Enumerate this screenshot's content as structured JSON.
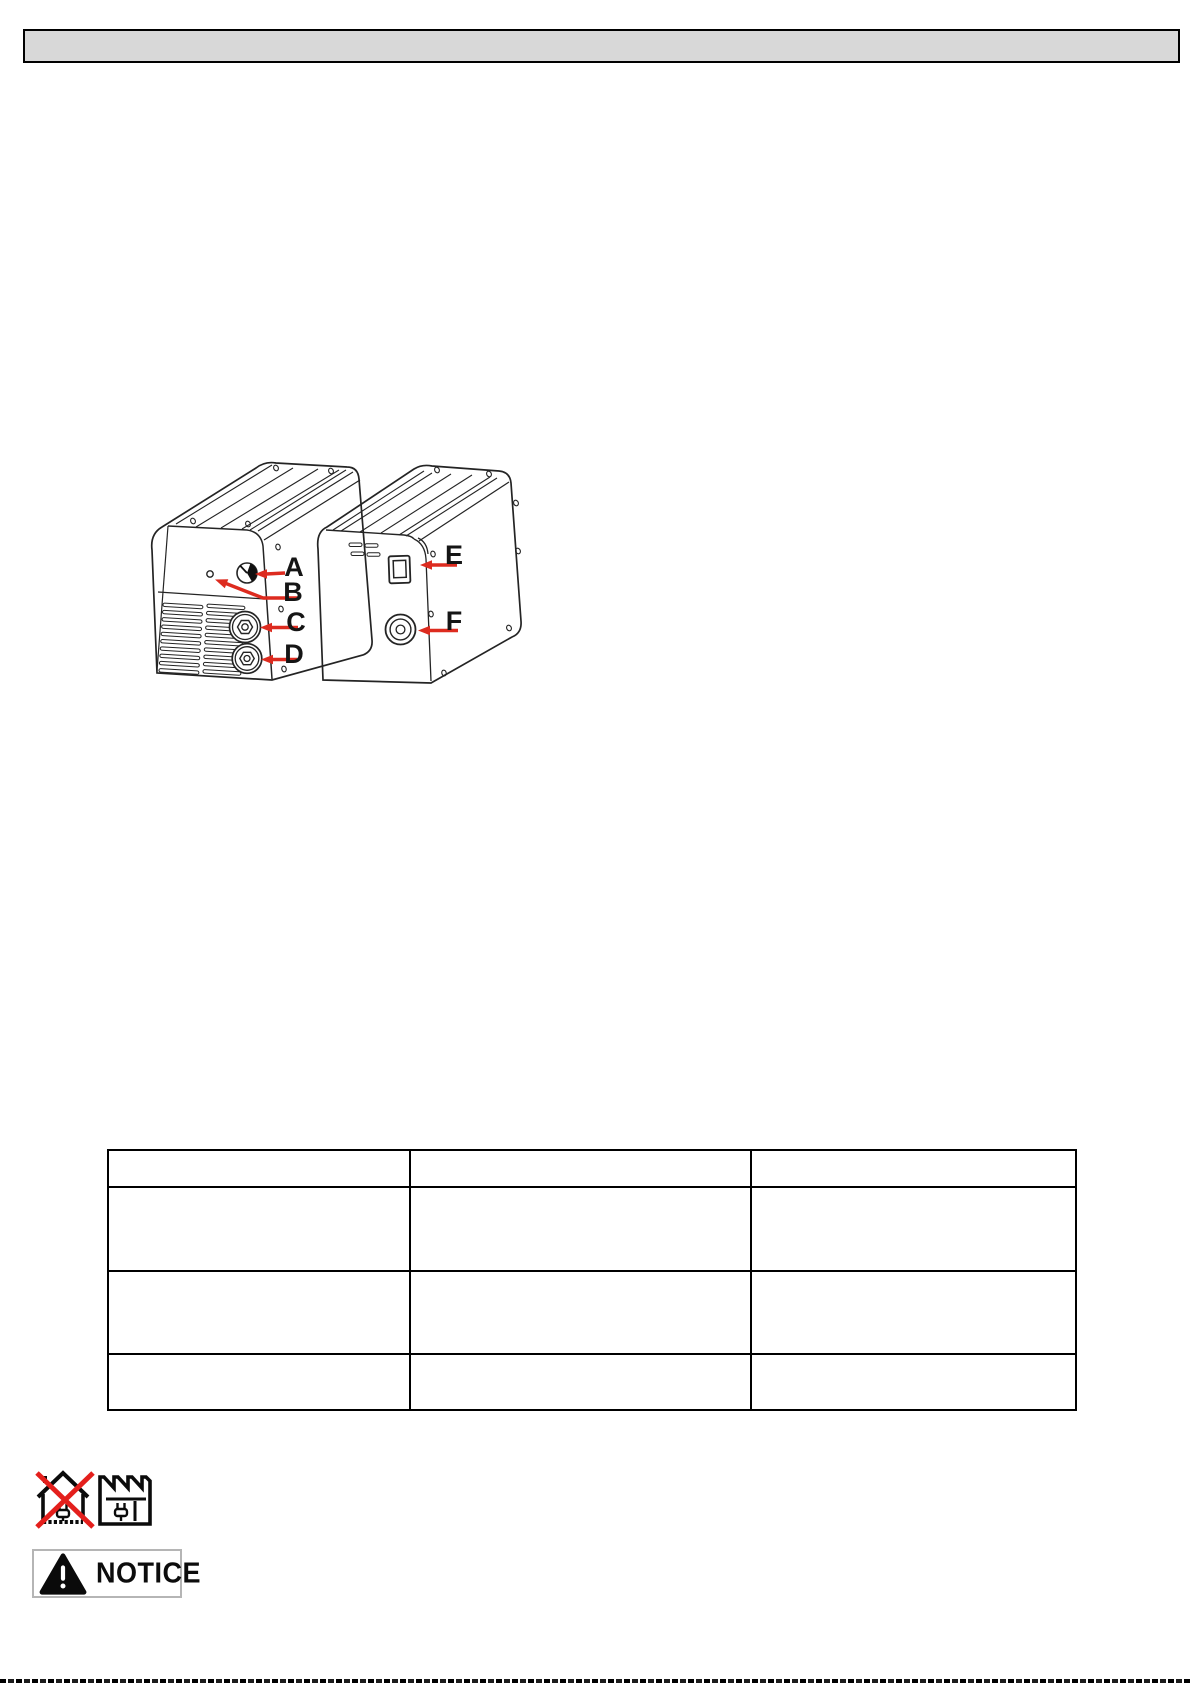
{
  "page": {
    "header_bar_color": "#d8d8d8",
    "background": "#ffffff"
  },
  "figure": {
    "labels": [
      "A",
      "B",
      "C",
      "D",
      "E",
      "F"
    ],
    "arrow_color": "#dd2b1f",
    "line_color": "#242424"
  },
  "table": {
    "header": [
      "",
      "",
      ""
    ],
    "rows": [
      [
        "",
        "",
        ""
      ],
      [
        "",
        "",
        ""
      ],
      [
        "",
        "",
        ""
      ]
    ]
  },
  "footer": {
    "notice_label": "NOTICE",
    "disposal_cross_color": "#e41f1c"
  }
}
